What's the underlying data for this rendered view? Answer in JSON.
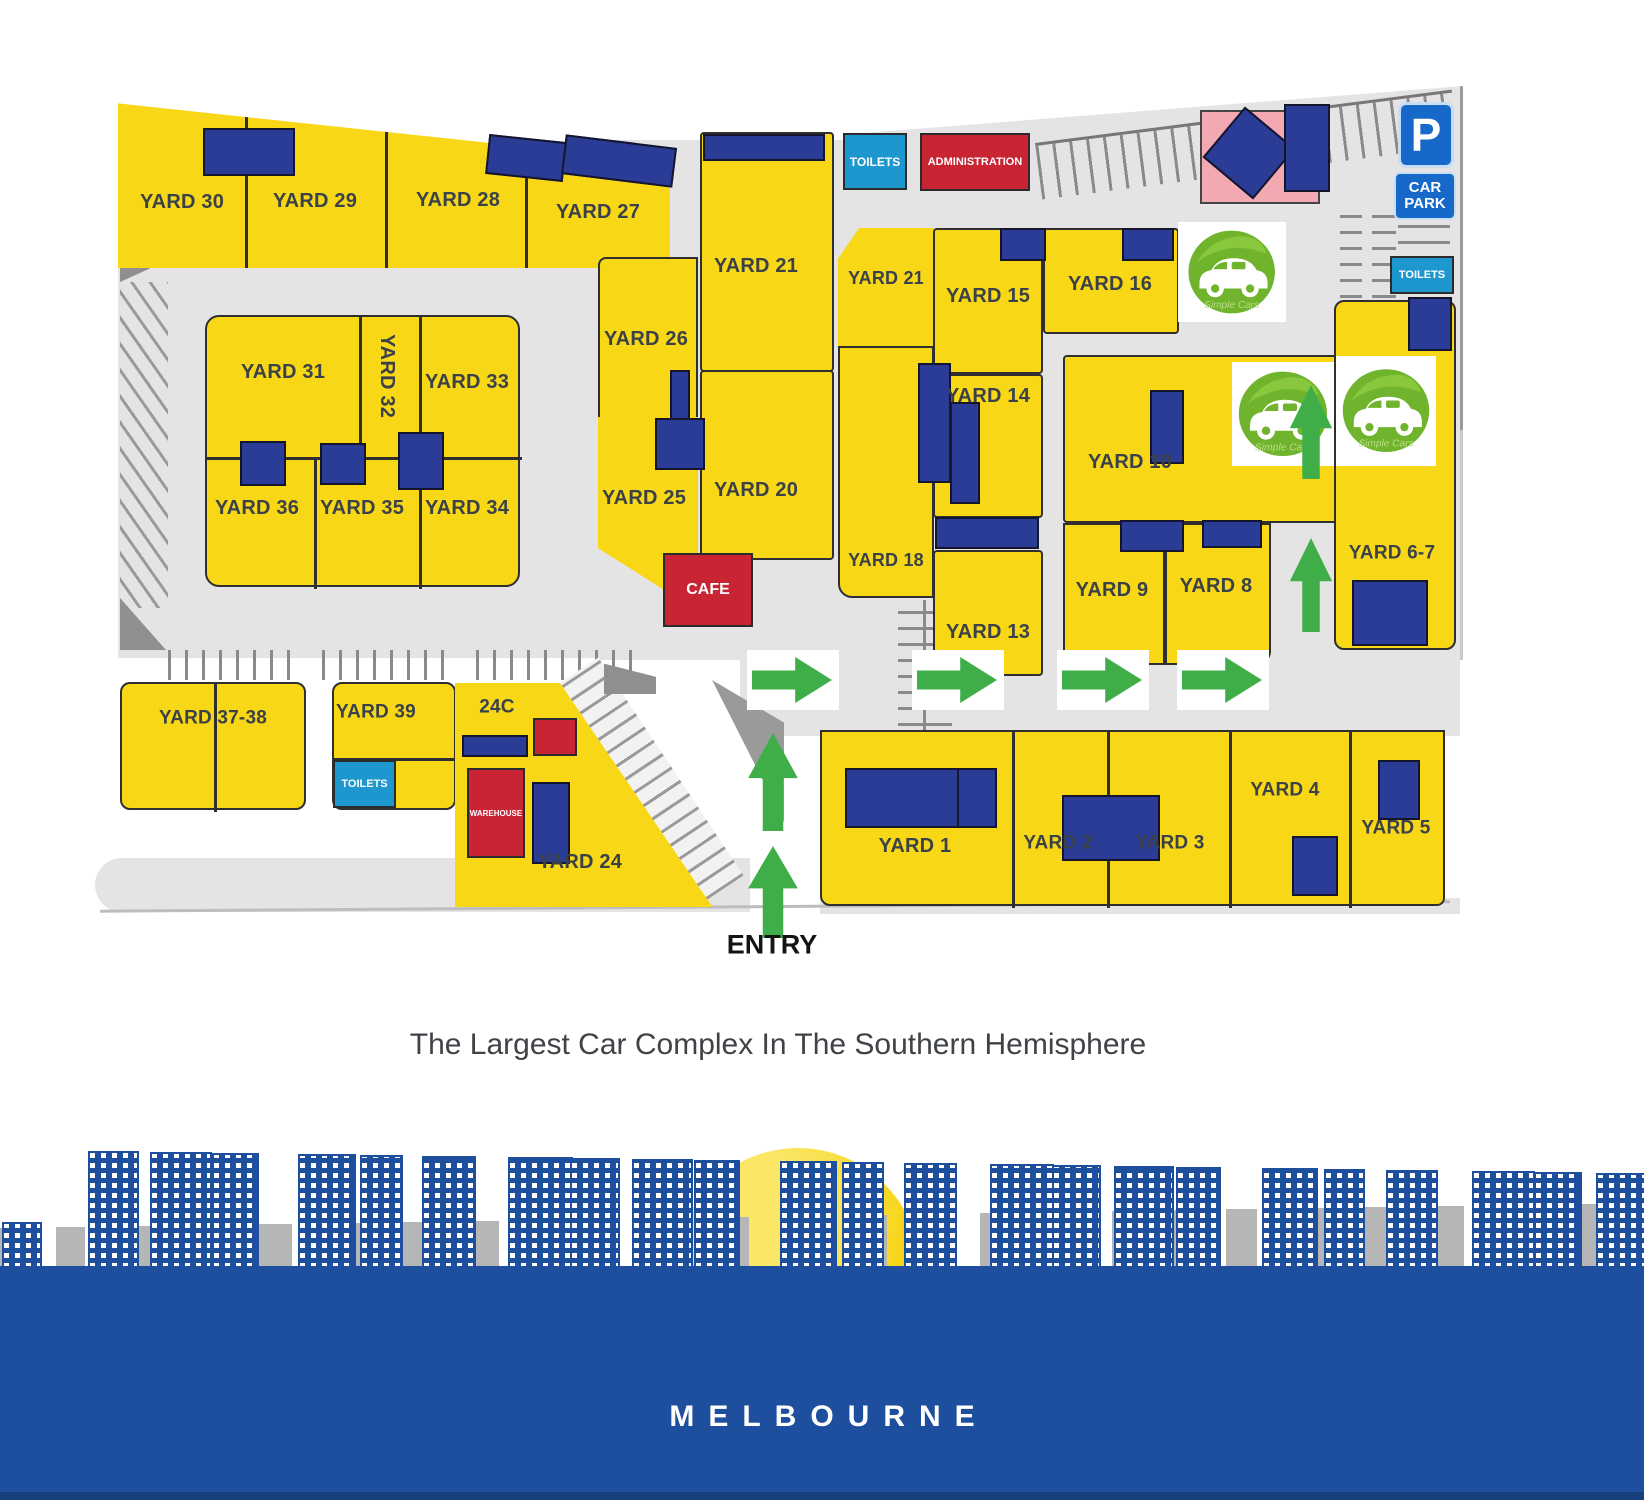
{
  "tagline": "The Largest Car Complex In The Southern Hemisphere",
  "footer": {
    "city": "MELBOURNE"
  },
  "logo_text": "Simple Cars",
  "signs": {
    "p": "P",
    "car_park": "CAR PARK",
    "entry": "ENTRY"
  },
  "facilities": {
    "toilets": "TOILETS",
    "administration": "ADMINISTRATION",
    "cafe": "CAFE",
    "warehouse": "WAREHOUSE"
  },
  "yards": {
    "y1": "YARD 1",
    "y2": "YARD 2",
    "y3": "YARD 3",
    "y4": "YARD 4",
    "y5": "YARD 5",
    "y67": "YARD 6-7",
    "y8": "YARD 8",
    "y9": "YARD 9",
    "y10": "YARD 10",
    "y13": "YARD 13",
    "y14": "YARD 14",
    "y15": "YARD 15",
    "y16": "YARD 16",
    "y18": "YARD 18",
    "y20": "YARD 20",
    "y21a": "YARD 21",
    "y21b": "YARD 21",
    "y24": "YARD 24",
    "y24c": "24C",
    "y25": "YARD 25",
    "y26": "YARD 26",
    "y27": "YARD 27",
    "y28": "YARD 28",
    "y29": "YARD 29",
    "y30": "YARD 30",
    "y31": "YARD 31",
    "y32": "YARD 32",
    "y33": "YARD 33",
    "y34": "YARD 34",
    "y35": "YARD 35",
    "y36": "YARD 36",
    "y3738": "YARD 37-38",
    "y39": "YARD 39"
  },
  "colors": {
    "yard_yellow": "#f8d816",
    "building_blue": "#2a3c96",
    "accent_red": "#c92433",
    "toilets_cyan": "#1e96ce",
    "sign_blue": "#1668c9",
    "arrow_green": "#3fae49",
    "road_gray": "#e4e4e4",
    "skyline_blue": "#1d4f9e",
    "pink": "#f2a9b1"
  }
}
